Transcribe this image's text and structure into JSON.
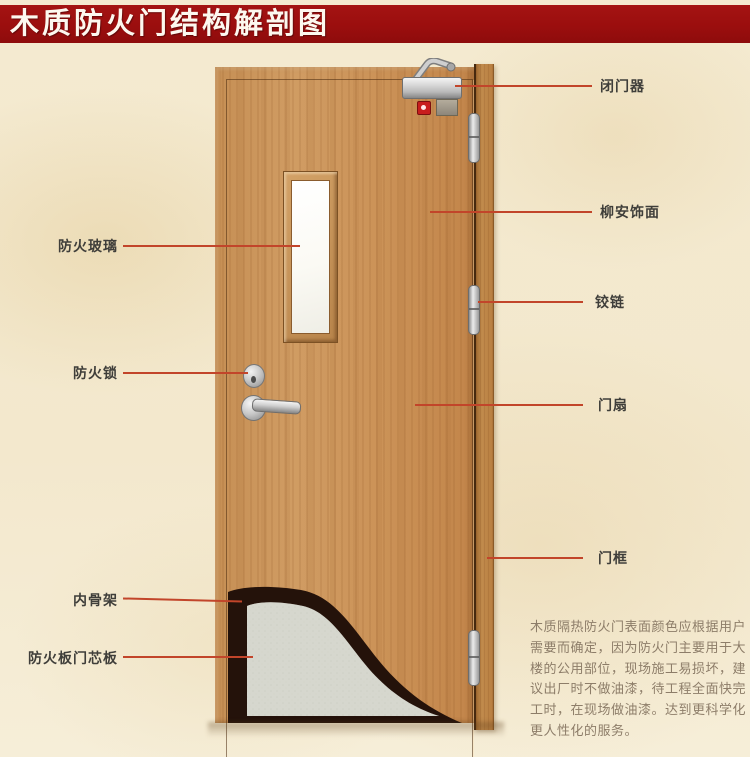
{
  "title": "木质防火门结构解剖图",
  "colors": {
    "banner": "#9b0e0e",
    "callout_line": "#c2452a",
    "door_wood": "#cb9257",
    "frame_wood": "#b97f41",
    "core_board": "#d6d7ce",
    "inner_skeleton": "#24120a",
    "background": "#f3e8cd"
  },
  "callouts": {
    "right": [
      {
        "id": "door-closer",
        "label": "闭门器"
      },
      {
        "id": "veneer",
        "label": "柳安饰面"
      },
      {
        "id": "hinge",
        "label": "铰链"
      },
      {
        "id": "door-leaf",
        "label": "门扇"
      },
      {
        "id": "door-frame",
        "label": "门框"
      }
    ],
    "left": [
      {
        "id": "fire-glass",
        "label": "防火玻璃"
      },
      {
        "id": "fire-lock",
        "label": "防火锁"
      },
      {
        "id": "inner-skeleton",
        "label": "内骨架"
      },
      {
        "id": "core-board",
        "label": "防火板门芯板"
      }
    ]
  },
  "description_lines": [
    "木质隔热防火门表面颜色应根据用户",
    "需要而确定，因为防火门主要用于大",
    "楼的公用部位，现场施工易损坏，建",
    "议出厂时不做油漆，待工程全面快完",
    "工时，在现场做油漆。达到更科学化",
    "更人性化的服务。"
  ]
}
